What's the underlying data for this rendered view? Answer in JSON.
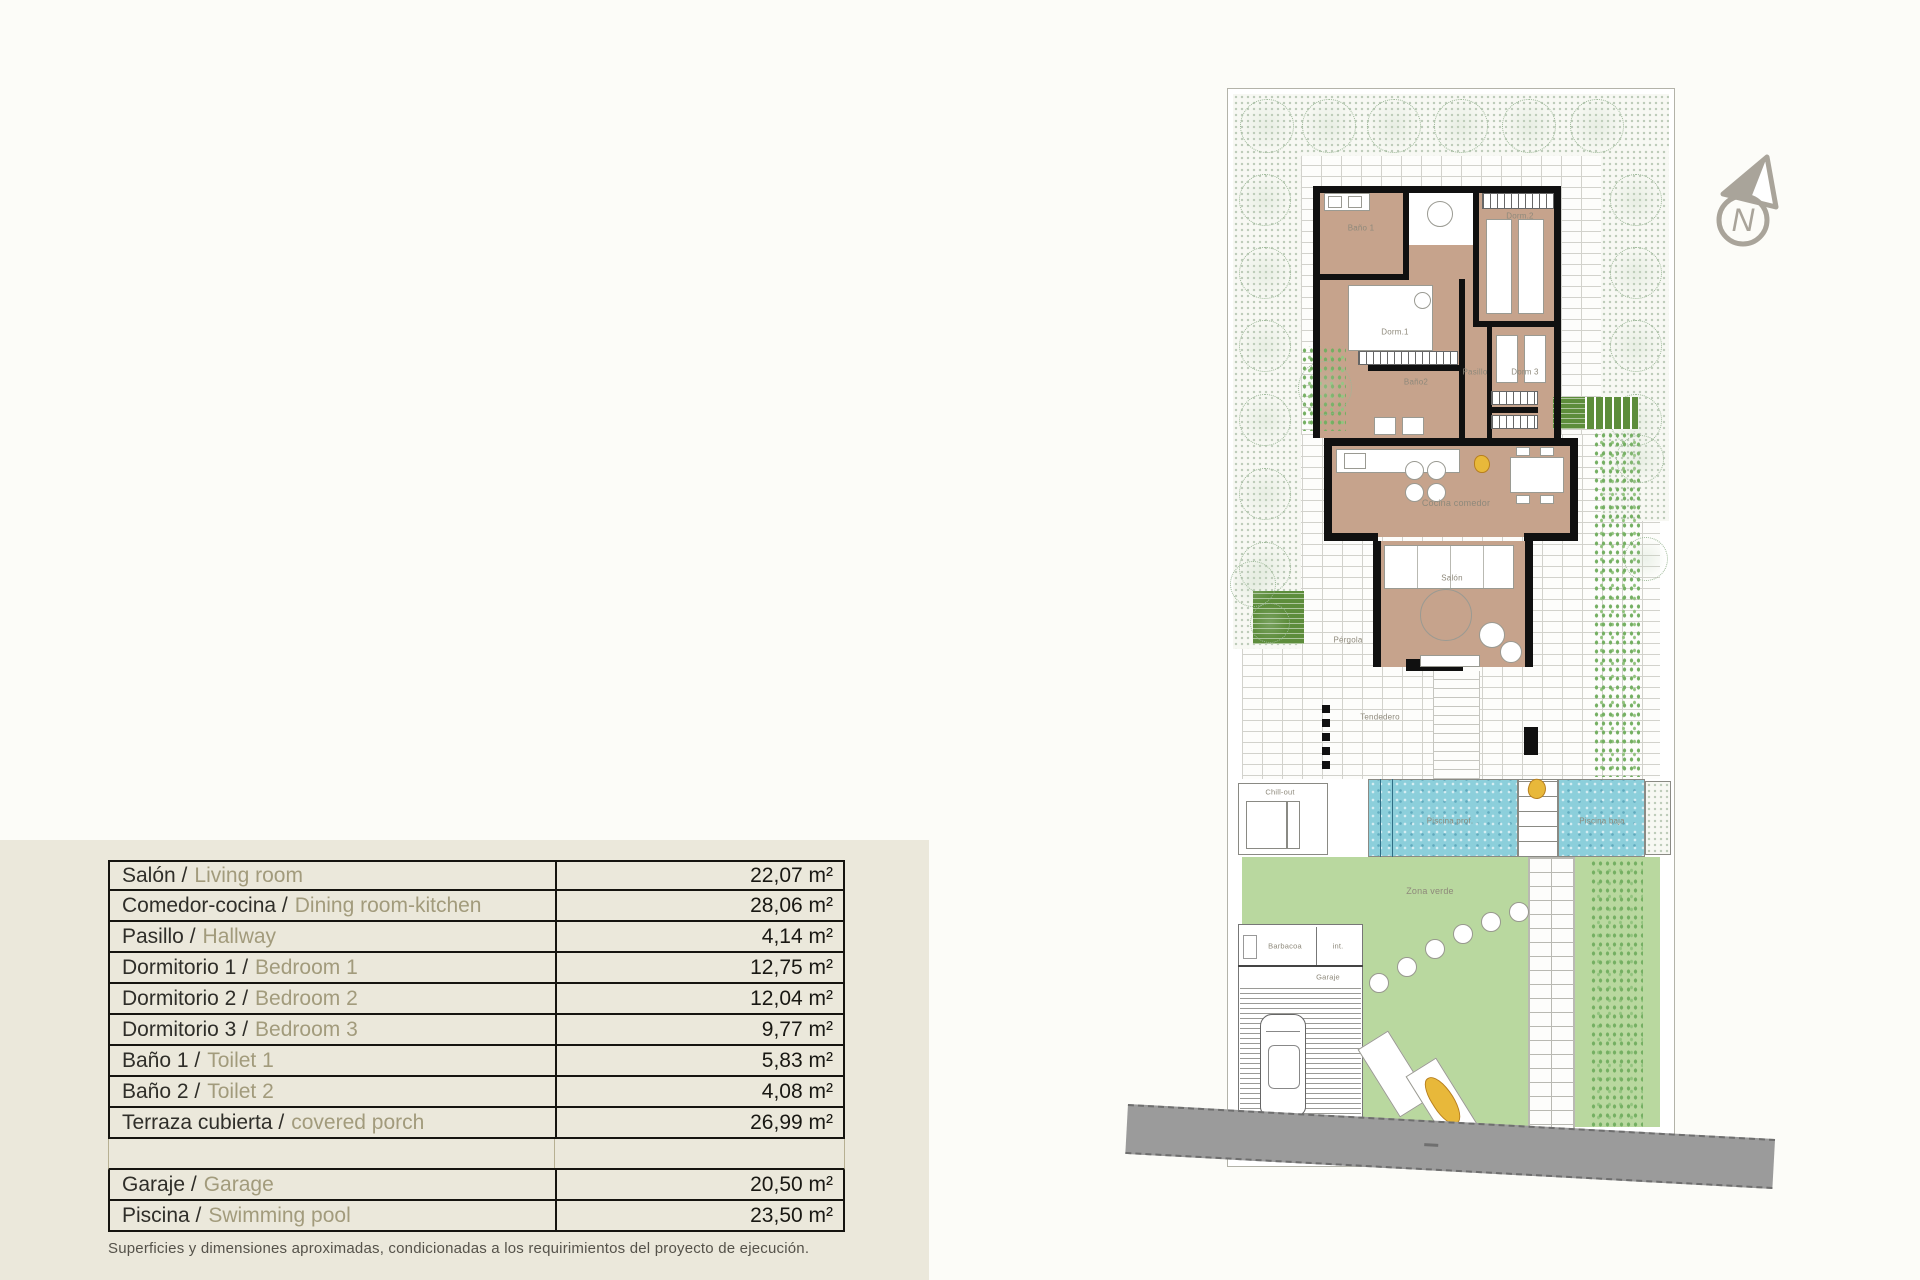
{
  "table": {
    "rows": [
      {
        "es": "Salón /",
        "en": "Living room",
        "value": "22,07 m²"
      },
      {
        "es": "Comedor-cocina /",
        "en": "Dining room-kitchen",
        "value": "28,06 m²"
      },
      {
        "es": "Pasillo /",
        "en": "Hallway",
        "value": "4,14 m²"
      },
      {
        "es": "Dormitorio 1 /",
        "en": "Bedroom 1",
        "value": "12,75 m²"
      },
      {
        "es": "Dormitorio 2 /",
        "en": "Bedroom 2",
        "value": "12,04 m²"
      },
      {
        "es": "Dormitorio 3 /",
        "en": "Bedroom 3",
        "value": "9,77 m²"
      },
      {
        "es": "Baño 1 /",
        "en": "Toilet 1",
        "value": "5,83 m²"
      },
      {
        "es": "Baño 2 /",
        "en": "Toilet 2",
        "value": "4,08 m²"
      },
      {
        "es": "Terraza cubierta /",
        "en": "covered porch",
        "value": "26,99 m²"
      },
      {
        "es": "",
        "en": "",
        "value": ""
      },
      {
        "es": "Garaje /",
        "en": "Garage",
        "value": "20,50 m²"
      },
      {
        "es": "Piscina /",
        "en": "Swimming pool",
        "value": "23,50 m²"
      }
    ]
  },
  "footnote": "Superficies y dimensiones aproximadas, condicionadas a los requirimientos del proyecto de ejecución.",
  "plan": {
    "labels": {
      "bano1": "Baño 1",
      "dorm1": "Dorm.1",
      "dorm2": "Dorm.2",
      "bano2": "Baño2",
      "pasillo": "Pasillo",
      "dorm3": "Dorm 3",
      "cocina": "Cocina comedor",
      "salon": "Salón",
      "pergola": "Pérgola",
      "tendedero": "Tendedero",
      "chillout": "Chill-out",
      "piscina_prof": "Piscina prof.",
      "piscina_baja": "Piscina baja",
      "zona_verde": "Zona verde",
      "barbacoa": "Barbacoa",
      "inst": "int.",
      "garaje": "Garaje"
    },
    "compass": {
      "letter": "N"
    }
  },
  "colors": {
    "panel_beige": "#ebe8db",
    "room_tan": "#c6a38c",
    "water_blue": "#8ccfdb",
    "lawn_green": "#b9d89f",
    "planter_green": "#5d8d3b",
    "road_gray": "#9b9b9b",
    "english_text": "#a29b7c",
    "compass_gray": "#a9a49a"
  }
}
